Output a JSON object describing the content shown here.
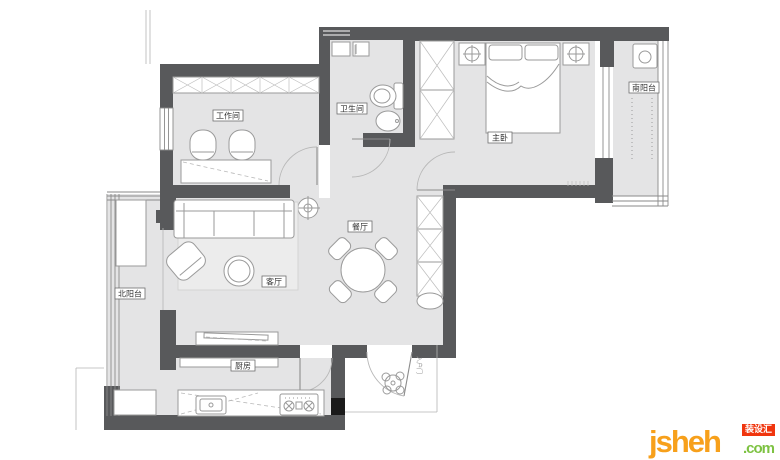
{
  "plan": {
    "rooms": [
      {
        "id": "workroom",
        "label": "工作间"
      },
      {
        "id": "bathroom",
        "label": "卫生间"
      },
      {
        "id": "master-bedroom",
        "label": "主卧"
      },
      {
        "id": "south-balcony",
        "label": "南阳台"
      },
      {
        "id": "dining-room",
        "label": "餐厅"
      },
      {
        "id": "living-room",
        "label": "客厅"
      },
      {
        "id": "north-balcony",
        "label": "北阳台"
      },
      {
        "id": "kitchen",
        "label": "厨房"
      },
      {
        "id": "entry",
        "label": "入户门"
      }
    ],
    "colors": {
      "wall": "#58595b",
      "floor": "#e4e4e5",
      "furniture_line": "#9a9a9a",
      "door_end_black": "#1a1a1a"
    }
  },
  "watermark": {
    "name": "jsheh",
    "tld": ".com",
    "badge": "装设汇"
  }
}
